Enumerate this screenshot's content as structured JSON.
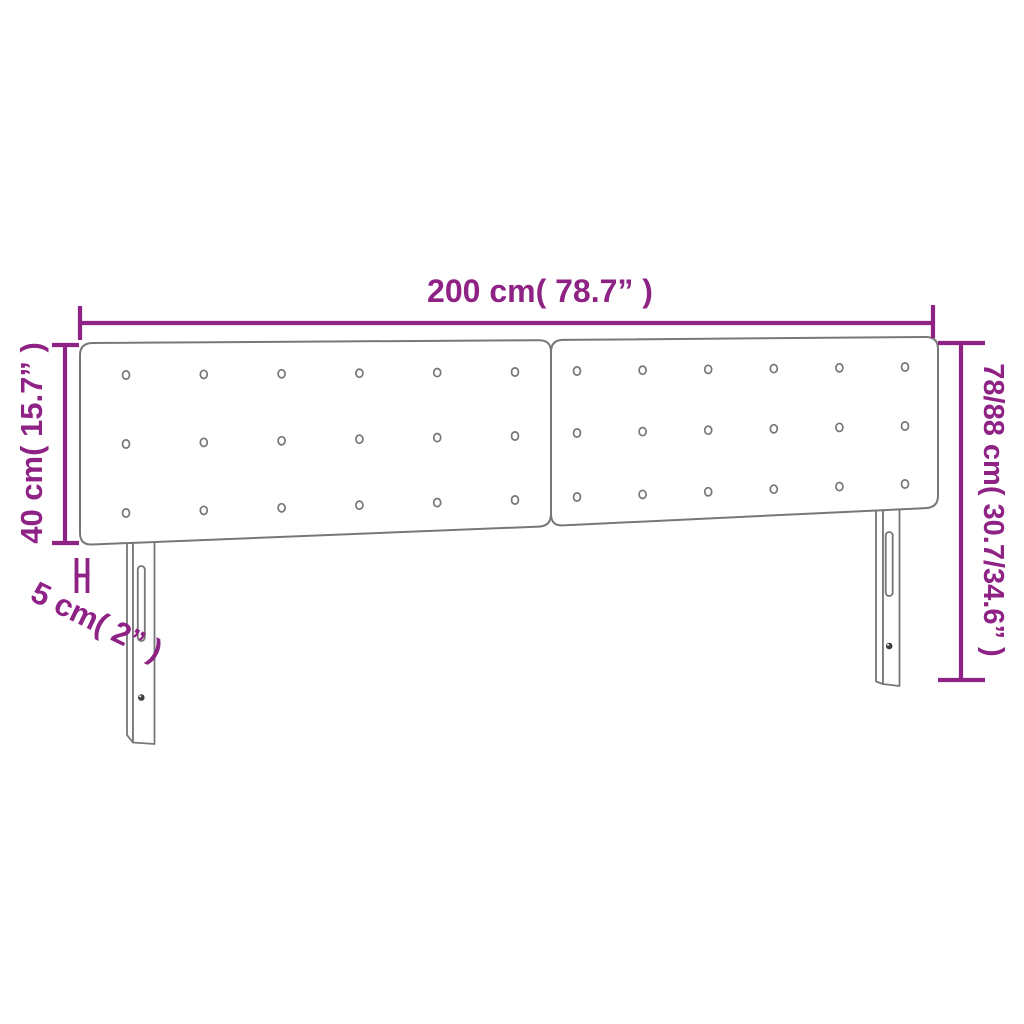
{
  "diagram": {
    "kind": "product-dimension-diagram",
    "subject": "tufted headboard, two panels with two slotted legs",
    "colors": {
      "dimension_accent": "#8E2285",
      "outline_gray": "#777777",
      "hole_dark": "#3f3f3f",
      "background": "#ffffff"
    },
    "dimensions": {
      "width": {
        "label": "200 cm( 78.7” )",
        "value_cm": 200,
        "value_in": 78.7
      },
      "panel_height": {
        "label": "40 cm( 15.7” )",
        "value_cm": 40,
        "value_in": 15.7
      },
      "thickness": {
        "label": "5 cm( 2” )",
        "value_cm": 5,
        "value_in": 2
      },
      "total_height": {
        "label": "78/88 cm( 30.7/34.6” )",
        "value_cm": "78/88",
        "value_in": "30.7/34.6"
      }
    },
    "figure": {
      "panels": 2,
      "button_rows": 3,
      "button_columns": 6,
      "legs": 2
    }
  }
}
